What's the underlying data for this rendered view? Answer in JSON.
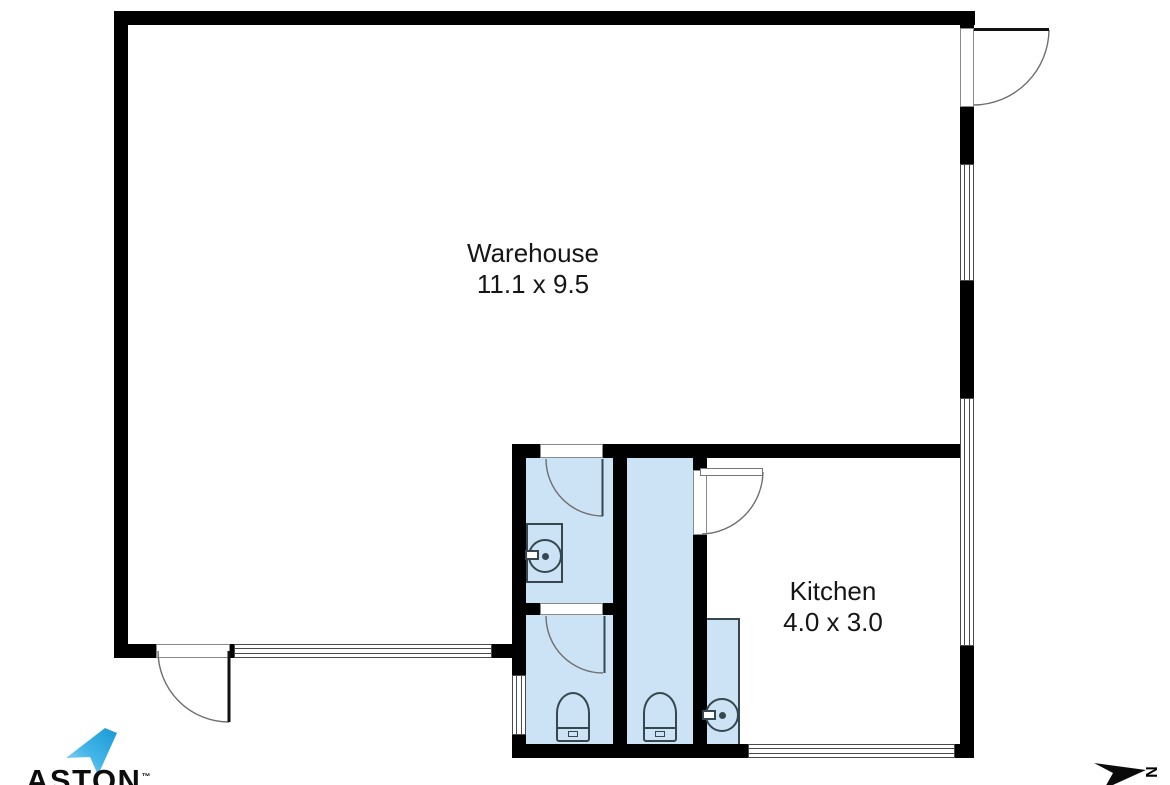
{
  "plan": {
    "rooms": [
      {
        "id": "warehouse",
        "name": "Warehouse",
        "dims": "11.1 x 9.5"
      },
      {
        "id": "kitchen",
        "name": "Kitchen",
        "dims": "4.0 x 3.0"
      },
      {
        "id": "bathroom-top",
        "fixtures": [
          "door",
          "washbasin"
        ]
      },
      {
        "id": "bathroom-bottom",
        "fixtures": [
          "door",
          "toilet"
        ]
      },
      {
        "id": "wc-middle",
        "fixtures": [
          "toilet"
        ]
      },
      {
        "id": "kitchen-wet-nook",
        "fixtures": [
          "washbasin"
        ]
      }
    ],
    "features": [
      "entry-door-top-right",
      "warehouse-door-bottom-left",
      "5-windows"
    ],
    "colors": {
      "wall": "#000000",
      "wet_area_fill": "#CBE3F5",
      "fixture_line": "#36474F",
      "door_arc": "#6E6E6E",
      "window_line": "#4A4A4A",
      "floor": "#FFFFFF",
      "logo_blue": "#1799D6"
    }
  },
  "branding": {
    "logo_text": "ASTON",
    "trademark": "™"
  },
  "compass": {
    "label": "N"
  }
}
